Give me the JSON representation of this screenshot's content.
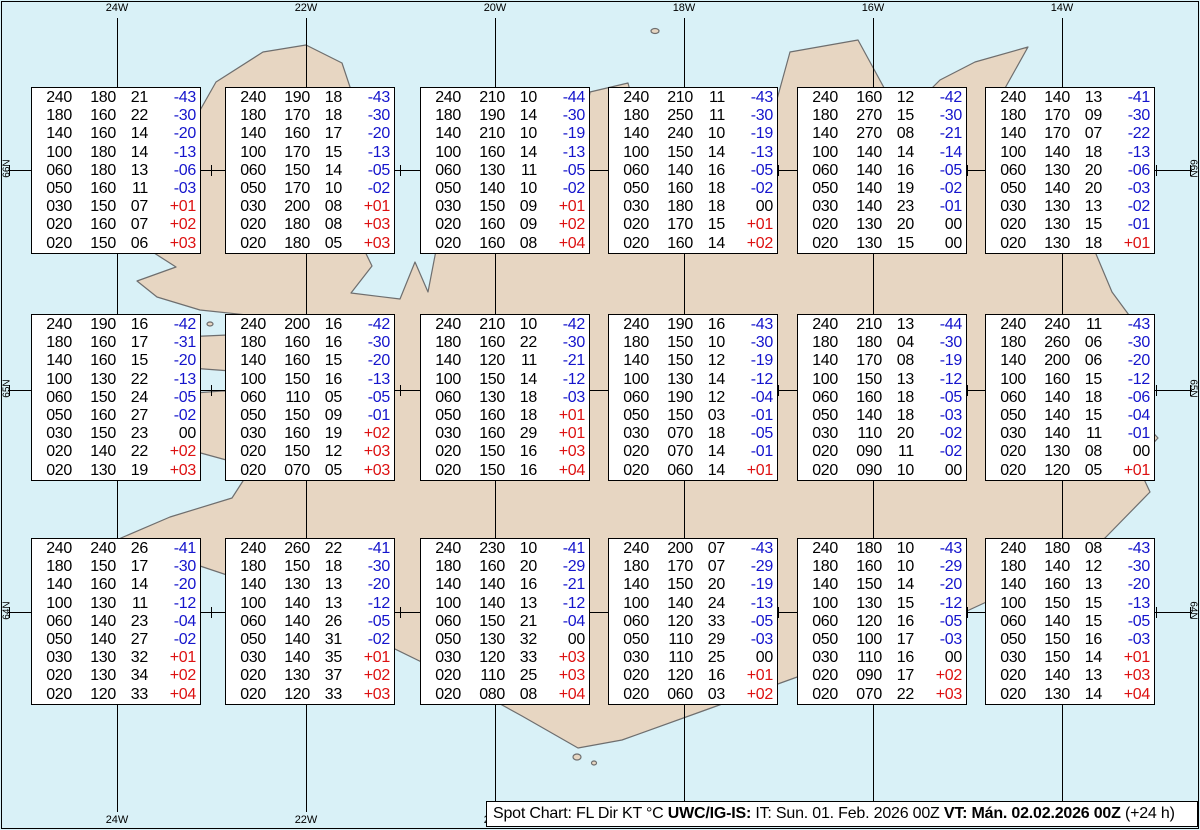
{
  "colors": {
    "sea": "#d9f1f7",
    "land": "#e7d6c2",
    "coast": "#6e6e6e",
    "neg": "#1414cc",
    "pos": "#dd1111"
  },
  "frame": {
    "meridians": [
      {
        "label": "24W",
        "x": 117
      },
      {
        "label": "22W",
        "x": 306
      },
      {
        "label": "20W",
        "x": 495
      },
      {
        "label": "18W",
        "x": 684
      },
      {
        "label": "16W",
        "x": 873
      },
      {
        "label": "14W",
        "x": 1062
      }
    ],
    "parallels": [
      {
        "label": "66N",
        "y": 170
      },
      {
        "label": "65N",
        "y": 390
      },
      {
        "label": "64N",
        "y": 612
      }
    ]
  },
  "caption": {
    "part1": "Spot Chart: FL Dir KT °C ",
    "part2": "UWC/IG-IS:",
    "part3": " IT: Sun. 01. Feb. 2026 00Z ",
    "part4": "VT: Mán. 02.02.2026 00Z",
    "part5": " (+24 h)"
  },
  "columns": [
    "FL",
    "Dir",
    "KT",
    "TempC"
  ],
  "boxes": [
    {
      "x": 31,
      "y": 87,
      "rows": [
        [
          "240",
          "180",
          "21",
          "-43"
        ],
        [
          "180",
          "160",
          "22",
          "-30"
        ],
        [
          "140",
          "160",
          "14",
          "-20"
        ],
        [
          "100",
          "180",
          "14",
          "-13"
        ],
        [
          "060",
          "180",
          "13",
          "-06"
        ],
        [
          "050",
          "160",
          "11",
          "-03"
        ],
        [
          "030",
          "150",
          "07",
          "+01"
        ],
        [
          "020",
          "160",
          "07",
          "+02"
        ],
        [
          "020",
          "150",
          "06",
          "+03"
        ]
      ]
    },
    {
      "x": 225,
      "y": 87,
      "rows": [
        [
          "240",
          "190",
          "18",
          "-43"
        ],
        [
          "180",
          "170",
          "18",
          "-30"
        ],
        [
          "140",
          "160",
          "17",
          "-20"
        ],
        [
          "100",
          "170",
          "15",
          "-13"
        ],
        [
          "060",
          "150",
          "14",
          "-05"
        ],
        [
          "050",
          "170",
          "10",
          "-02"
        ],
        [
          "030",
          "200",
          "08",
          "+01"
        ],
        [
          "020",
          "180",
          "08",
          "+03"
        ],
        [
          "020",
          "180",
          "05",
          "+03"
        ]
      ]
    },
    {
      "x": 420,
      "y": 87,
      "rows": [
        [
          "240",
          "210",
          "10",
          "-44"
        ],
        [
          "180",
          "190",
          "14",
          "-30"
        ],
        [
          "140",
          "210",
          "10",
          "-19"
        ],
        [
          "100",
          "160",
          "14",
          "-13"
        ],
        [
          "060",
          "130",
          "11",
          "-05"
        ],
        [
          "050",
          "140",
          "10",
          "-02"
        ],
        [
          "030",
          "150",
          "09",
          "+01"
        ],
        [
          "020",
          "160",
          "09",
          "+02"
        ],
        [
          "020",
          "160",
          "08",
          "+04"
        ]
      ]
    },
    {
      "x": 608,
      "y": 87,
      "rows": [
        [
          "240",
          "210",
          "11",
          "-43"
        ],
        [
          "180",
          "250",
          "11",
          "-30"
        ],
        [
          "140",
          "240",
          "10",
          "-19"
        ],
        [
          "100",
          "150",
          "14",
          "-13"
        ],
        [
          "060",
          "140",
          "16",
          "-05"
        ],
        [
          "050",
          "160",
          "18",
          "-02"
        ],
        [
          "030",
          "180",
          "18",
          "00"
        ],
        [
          "020",
          "170",
          "15",
          "+01"
        ],
        [
          "020",
          "160",
          "14",
          "+02"
        ]
      ]
    },
    {
      "x": 797,
      "y": 87,
      "rows": [
        [
          "240",
          "160",
          "12",
          "-42"
        ],
        [
          "180",
          "270",
          "15",
          "-30"
        ],
        [
          "140",
          "270",
          "08",
          "-21"
        ],
        [
          "100",
          "140",
          "14",
          "-14"
        ],
        [
          "060",
          "140",
          "16",
          "-05"
        ],
        [
          "050",
          "140",
          "19",
          "-02"
        ],
        [
          "030",
          "140",
          "23",
          "-01"
        ],
        [
          "020",
          "130",
          "20",
          "00"
        ],
        [
          "020",
          "130",
          "15",
          "00"
        ]
      ]
    },
    {
      "x": 985,
      "y": 87,
      "rows": [
        [
          "240",
          "140",
          "13",
          "-41"
        ],
        [
          "180",
          "170",
          "09",
          "-30"
        ],
        [
          "140",
          "170",
          "07",
          "-22"
        ],
        [
          "100",
          "140",
          "18",
          "-13"
        ],
        [
          "060",
          "130",
          "20",
          "-06"
        ],
        [
          "050",
          "140",
          "20",
          "-03"
        ],
        [
          "030",
          "130",
          "13",
          "-02"
        ],
        [
          "020",
          "130",
          "15",
          "-01"
        ],
        [
          "020",
          "130",
          "18",
          "+01"
        ]
      ]
    },
    {
      "x": 31,
      "y": 314,
      "rows": [
        [
          "240",
          "190",
          "16",
          "-42"
        ],
        [
          "180",
          "160",
          "17",
          "-31"
        ],
        [
          "140",
          "160",
          "15",
          "-20"
        ],
        [
          "100",
          "130",
          "22",
          "-13"
        ],
        [
          "060",
          "150",
          "24",
          "-05"
        ],
        [
          "050",
          "160",
          "27",
          "-02"
        ],
        [
          "030",
          "150",
          "23",
          "00"
        ],
        [
          "020",
          "140",
          "22",
          "+02"
        ],
        [
          "020",
          "130",
          "19",
          "+03"
        ]
      ]
    },
    {
      "x": 225,
      "y": 314,
      "rows": [
        [
          "240",
          "200",
          "16",
          "-42"
        ],
        [
          "180",
          "160",
          "16",
          "-30"
        ],
        [
          "140",
          "160",
          "15",
          "-20"
        ],
        [
          "100",
          "150",
          "16",
          "-13"
        ],
        [
          "060",
          "110",
          "05",
          "-05"
        ],
        [
          "050",
          "150",
          "09",
          "-01"
        ],
        [
          "030",
          "160",
          "19",
          "+02"
        ],
        [
          "020",
          "150",
          "12",
          "+03"
        ],
        [
          "020",
          "070",
          "05",
          "+03"
        ]
      ]
    },
    {
      "x": 420,
      "y": 314,
      "rows": [
        [
          "240",
          "210",
          "10",
          "-42"
        ],
        [
          "180",
          "160",
          "22",
          "-30"
        ],
        [
          "140",
          "120",
          "11",
          "-21"
        ],
        [
          "100",
          "150",
          "14",
          "-12"
        ],
        [
          "060",
          "130",
          "18",
          "-03"
        ],
        [
          "050",
          "160",
          "18",
          "+01"
        ],
        [
          "030",
          "160",
          "29",
          "+01"
        ],
        [
          "020",
          "150",
          "16",
          "+03"
        ],
        [
          "020",
          "150",
          "16",
          "+04"
        ]
      ]
    },
    {
      "x": 608,
      "y": 314,
      "rows": [
        [
          "240",
          "190",
          "16",
          "-43"
        ],
        [
          "180",
          "150",
          "10",
          "-30"
        ],
        [
          "140",
          "150",
          "12",
          "-19"
        ],
        [
          "100",
          "130",
          "14",
          "-12"
        ],
        [
          "060",
          "190",
          "12",
          "-04"
        ],
        [
          "050",
          "150",
          "03",
          "-01"
        ],
        [
          "030",
          "070",
          "18",
          "-05"
        ],
        [
          "020",
          "070",
          "14",
          "-01"
        ],
        [
          "020",
          "060",
          "14",
          "+01"
        ]
      ]
    },
    {
      "x": 797,
      "y": 314,
      "rows": [
        [
          "240",
          "210",
          "13",
          "-44"
        ],
        [
          "180",
          "180",
          "04",
          "-30"
        ],
        [
          "140",
          "170",
          "08",
          "-19"
        ],
        [
          "100",
          "150",
          "13",
          "-12"
        ],
        [
          "060",
          "160",
          "18",
          "-05"
        ],
        [
          "050",
          "140",
          "18",
          "-03"
        ],
        [
          "030",
          "110",
          "20",
          "-02"
        ],
        [
          "020",
          "090",
          "11",
          "-02"
        ],
        [
          "020",
          "090",
          "10",
          "00"
        ]
      ]
    },
    {
      "x": 985,
      "y": 314,
      "rows": [
        [
          "240",
          "240",
          "11",
          "-43"
        ],
        [
          "180",
          "260",
          "06",
          "-30"
        ],
        [
          "140",
          "200",
          "06",
          "-20"
        ],
        [
          "100",
          "160",
          "15",
          "-12"
        ],
        [
          "060",
          "140",
          "18",
          "-06"
        ],
        [
          "050",
          "140",
          "15",
          "-04"
        ],
        [
          "030",
          "140",
          "11",
          "-01"
        ],
        [
          "020",
          "130",
          "08",
          "00"
        ],
        [
          "020",
          "120",
          "05",
          "+01"
        ]
      ]
    },
    {
      "x": 31,
      "y": 538,
      "rows": [
        [
          "240",
          "240",
          "26",
          "-41"
        ],
        [
          "180",
          "150",
          "17",
          "-30"
        ],
        [
          "140",
          "160",
          "14",
          "-20"
        ],
        [
          "100",
          "130",
          "11",
          "-12"
        ],
        [
          "060",
          "140",
          "23",
          "-04"
        ],
        [
          "050",
          "140",
          "27",
          "-02"
        ],
        [
          "030",
          "130",
          "32",
          "+01"
        ],
        [
          "020",
          "130",
          "34",
          "+02"
        ],
        [
          "020",
          "120",
          "33",
          "+04"
        ]
      ]
    },
    {
      "x": 225,
      "y": 538,
      "rows": [
        [
          "240",
          "260",
          "22",
          "-41"
        ],
        [
          "180",
          "150",
          "18",
          "-30"
        ],
        [
          "140",
          "130",
          "13",
          "-20"
        ],
        [
          "100",
          "140",
          "13",
          "-12"
        ],
        [
          "060",
          "140",
          "26",
          "-05"
        ],
        [
          "050",
          "140",
          "31",
          "-02"
        ],
        [
          "030",
          "140",
          "35",
          "+01"
        ],
        [
          "020",
          "130",
          "37",
          "+02"
        ],
        [
          "020",
          "120",
          "33",
          "+03"
        ]
      ]
    },
    {
      "x": 420,
      "y": 538,
      "rows": [
        [
          "240",
          "230",
          "10",
          "-41"
        ],
        [
          "180",
          "160",
          "20",
          "-29"
        ],
        [
          "140",
          "140",
          "16",
          "-21"
        ],
        [
          "100",
          "140",
          "13",
          "-12"
        ],
        [
          "060",
          "150",
          "21",
          "-04"
        ],
        [
          "050",
          "130",
          "32",
          "00"
        ],
        [
          "030",
          "120",
          "33",
          "+03"
        ],
        [
          "020",
          "110",
          "25",
          "+03"
        ],
        [
          "020",
          "080",
          "08",
          "+04"
        ]
      ]
    },
    {
      "x": 608,
      "y": 538,
      "rows": [
        [
          "240",
          "200",
          "07",
          "-43"
        ],
        [
          "180",
          "170",
          "07",
          "-29"
        ],
        [
          "140",
          "150",
          "20",
          "-19"
        ],
        [
          "100",
          "140",
          "24",
          "-13"
        ],
        [
          "060",
          "120",
          "33",
          "-05"
        ],
        [
          "050",
          "110",
          "29",
          "-03"
        ],
        [
          "030",
          "110",
          "25",
          "00"
        ],
        [
          "020",
          "120",
          "16",
          "+01"
        ],
        [
          "020",
          "060",
          "03",
          "+02"
        ]
      ]
    },
    {
      "x": 797,
      "y": 538,
      "rows": [
        [
          "240",
          "180",
          "10",
          "-43"
        ],
        [
          "180",
          "160",
          "10",
          "-29"
        ],
        [
          "140",
          "150",
          "14",
          "-20"
        ],
        [
          "100",
          "130",
          "15",
          "-12"
        ],
        [
          "060",
          "120",
          "16",
          "-05"
        ],
        [
          "050",
          "100",
          "17",
          "-03"
        ],
        [
          "030",
          "110",
          "16",
          "00"
        ],
        [
          "020",
          "090",
          "17",
          "+02"
        ],
        [
          "020",
          "070",
          "22",
          "+03"
        ]
      ]
    },
    {
      "x": 985,
      "y": 538,
      "rows": [
        [
          "240",
          "180",
          "08",
          "-43"
        ],
        [
          "180",
          "140",
          "12",
          "-30"
        ],
        [
          "140",
          "160",
          "13",
          "-20"
        ],
        [
          "100",
          "150",
          "15",
          "-13"
        ],
        [
          "060",
          "140",
          "15",
          "-05"
        ],
        [
          "050",
          "150",
          "16",
          "-03"
        ],
        [
          "030",
          "150",
          "14",
          "+01"
        ],
        [
          "020",
          "140",
          "13",
          "+03"
        ],
        [
          "020",
          "130",
          "14",
          "+04"
        ]
      ]
    }
  ]
}
